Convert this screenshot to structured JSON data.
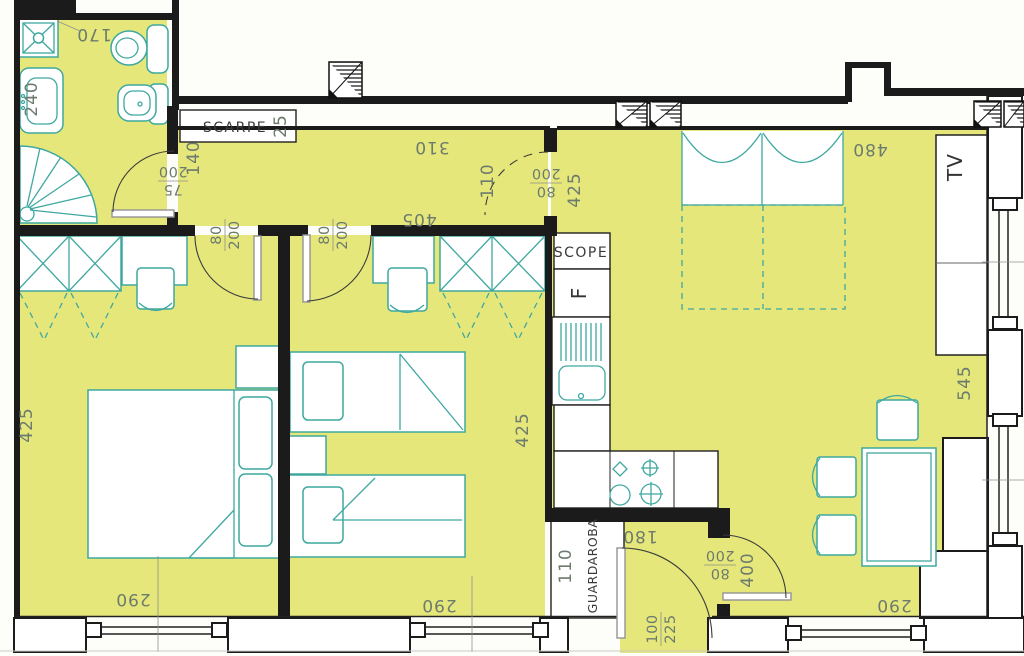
{
  "colors": {
    "floor": "#e5e77b",
    "fixture": "#3fa8a0",
    "wall": "#1b1b1b",
    "dim_text": "#6d7b6e"
  },
  "plan": {
    "bathroom": {
      "shower_dim": "170",
      "sink_dim": "240",
      "door": {
        "w": "75",
        "h": "200"
      }
    },
    "hallway": {
      "shoe_cabinet_label": "SCARPE",
      "shoe_cabinet_dim": "25",
      "width_dim": "140",
      "length_dim": "310",
      "opening_dim": "110",
      "opening_door": {
        "w": "80",
        "h": "200"
      },
      "living_edge_dim": "425"
    },
    "bedroom1": {
      "door": {
        "w": "80",
        "h": "200"
      },
      "width_dim": "425",
      "window_dim": "290"
    },
    "bedroom2": {
      "top_dim": "405",
      "door": {
        "w": "80",
        "h": "200"
      },
      "width_dim": "425",
      "window_dim": "290"
    },
    "kitchen": {
      "broom_label": "SCOPE",
      "fridge_label": "F"
    },
    "living": {
      "sofa_dim": "480",
      "tv_label": "TV",
      "depth_dim": "545",
      "window_dim": "290",
      "door": {
        "w": "80",
        "h": "200"
      },
      "door_wall_dim": "400"
    },
    "entry": {
      "closet_dim": "110",
      "closet_label": "GUARDAROBA",
      "width_dim": "180",
      "door": {
        "w": "100",
        "h": "225"
      }
    }
  }
}
